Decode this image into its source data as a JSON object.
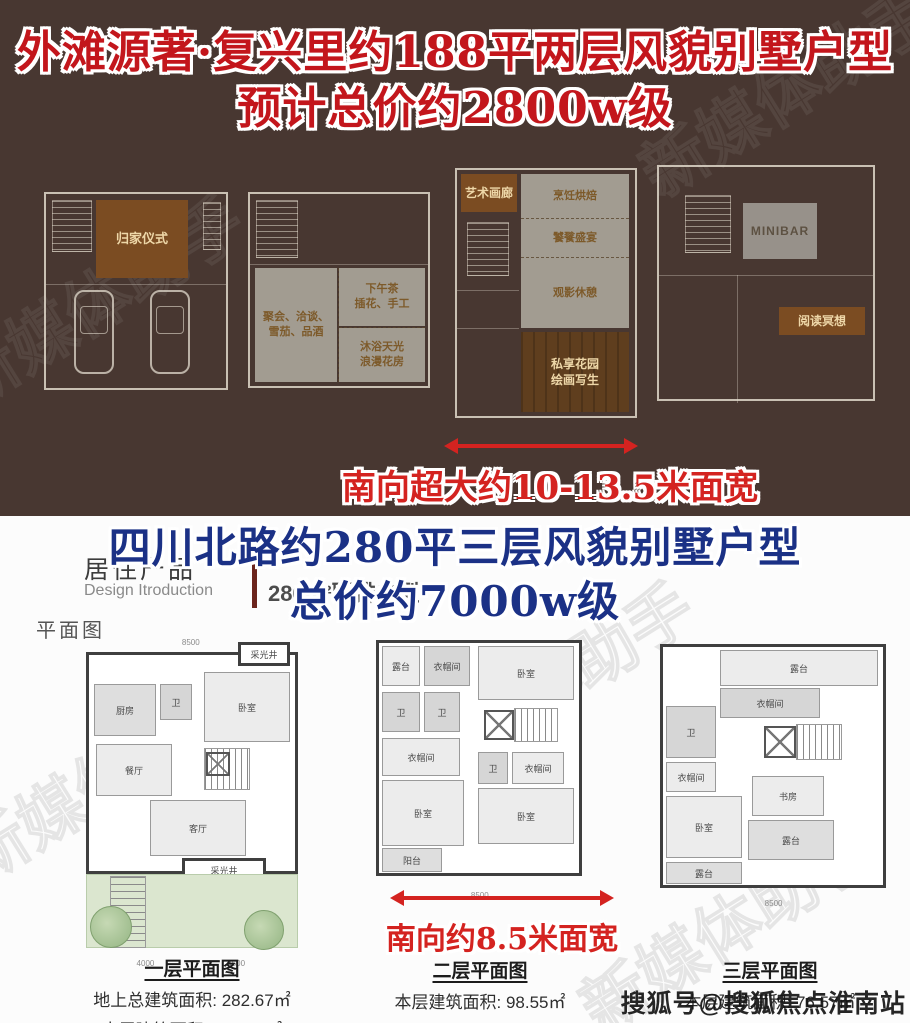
{
  "top_section": {
    "bg_color": "#483731",
    "title_color": "#c3161c",
    "title_line1": "外滩源著·复兴里约188平两层风貌别墅户型",
    "title_line2": "预计总价约2800w级",
    "arrow_note": "南向超大约10-13.5米面宽",
    "plans": [
      {
        "rooms": [
          "归家仪式"
        ]
      },
      {
        "rooms": [
          "聚会、洽谈、\n雪茄、品酒",
          "下午茶\n插花、手工",
          "沐浴天光\n浪漫花房"
        ]
      },
      {
        "rooms": [
          "艺术画廊",
          "烹饪烘焙",
          "饕餮盛宴",
          "观影休憩",
          "私享花园\n绘画写生"
        ]
      },
      {
        "rooms": [
          "MINIBAR",
          "阅读冥想"
        ]
      }
    ]
  },
  "bottom_section": {
    "title_color": "#1b3186",
    "title_line1": "四川北路约280平三层风貌别墅户型",
    "title_line2": "总价约7000w级",
    "product_label": "居住产品",
    "product_sublabel": "Design Itroduction",
    "product_type": "280m²联排户型",
    "plan_view_label": "平面图",
    "arrow_note": "南向约8.5米面宽",
    "plans": [
      {
        "caption": "一层平面图",
        "area_lines": [
          "地上总建筑面积: 282.67㎡",
          "本层建筑面积: 107.55㎡"
        ],
        "rooms": [
          "采光井",
          "厨房",
          "卫",
          "卧室",
          "餐厅",
          "客厅",
          "采光井"
        ],
        "dims": [
          "8500",
          "4000",
          "4500"
        ]
      },
      {
        "caption": "二层平面图",
        "area_lines": [
          "本层建筑面积: 98.55㎡"
        ],
        "rooms": [
          "露台",
          "衣帽间",
          "卧室",
          "卫",
          "卫",
          "衣帽间",
          "卫",
          "衣帽间",
          "卧室",
          "卧室",
          "阳台"
        ],
        "dims": [
          "8500"
        ]
      },
      {
        "caption": "三层平面图",
        "area_lines": [
          "本层建筑面积: 76.57㎡"
        ],
        "rooms": [
          "露台",
          "衣帽间",
          "卫",
          "衣帽间",
          "卧室",
          "书房",
          "露台",
          "露台"
        ],
        "dims": [
          "8500"
        ]
      }
    ]
  },
  "watermarks": {
    "diagonal": "新媒体助手",
    "sohu": "搜狐号@搜狐焦点淮南站"
  }
}
